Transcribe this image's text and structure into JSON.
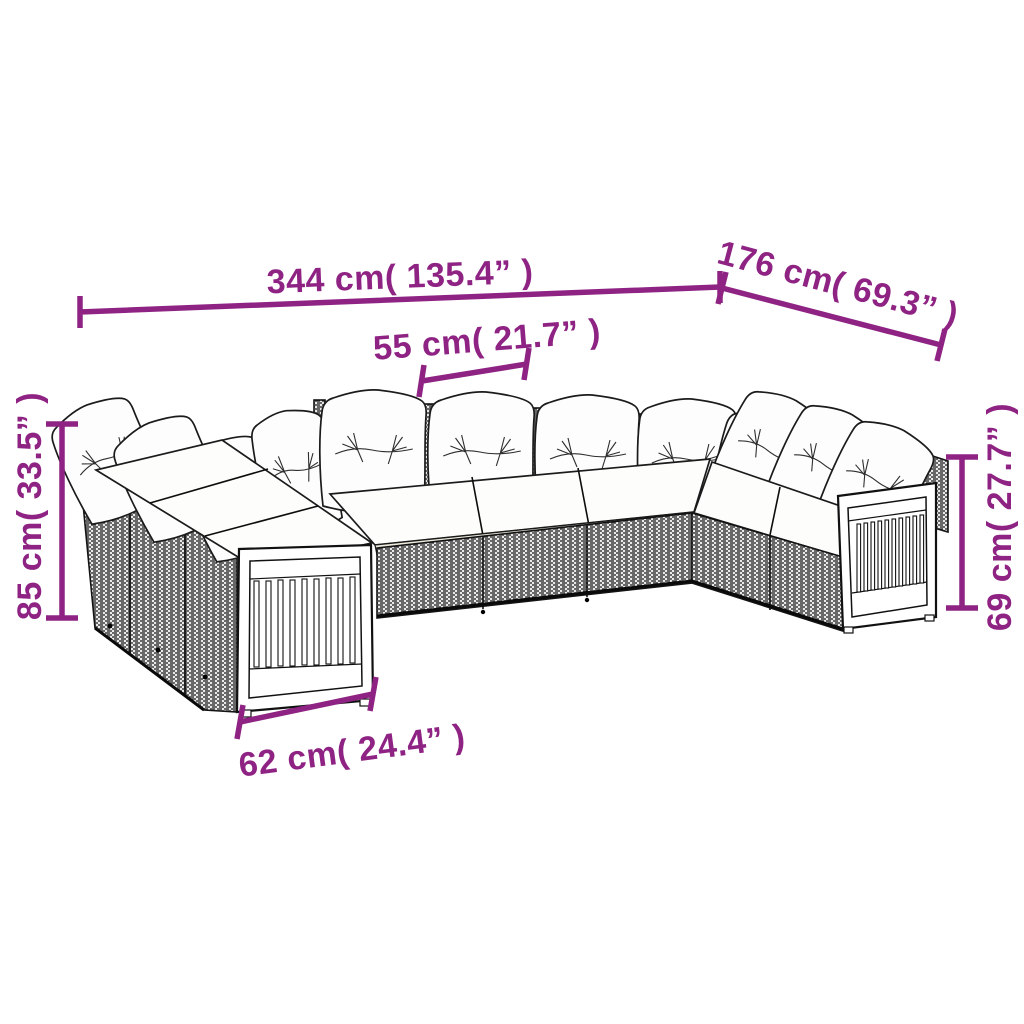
{
  "colors": {
    "annotation": "#8E2383",
    "outline": "#1b1b1b",
    "rattan_dark": "#3d3d3d",
    "rattan_light": "#e9e9e9",
    "cushion_white": "#fdfdfb",
    "cushion_side": "#efecdf"
  },
  "measurements": {
    "overall_width": {
      "label": "344 cm( 135.4” )",
      "cm": 344,
      "inches": 135.4
    },
    "total_depth": {
      "label": "176 cm( 69.3” )",
      "cm": 176,
      "inches": 69.3
    },
    "seat_width": {
      "label": "55 cm( 21.7” )",
      "cm": 55,
      "inches": 21.7
    },
    "back_height": {
      "label": "85 cm( 33.5” )",
      "cm": 85,
      "inches": 33.5
    },
    "arm_height": {
      "label": "69 cm( 27.7” )",
      "cm": 69,
      "inches": 27.7
    },
    "armrest_width": {
      "label": "62 cm( 24.4” )",
      "cm": 62,
      "inches": 24.4
    }
  }
}
